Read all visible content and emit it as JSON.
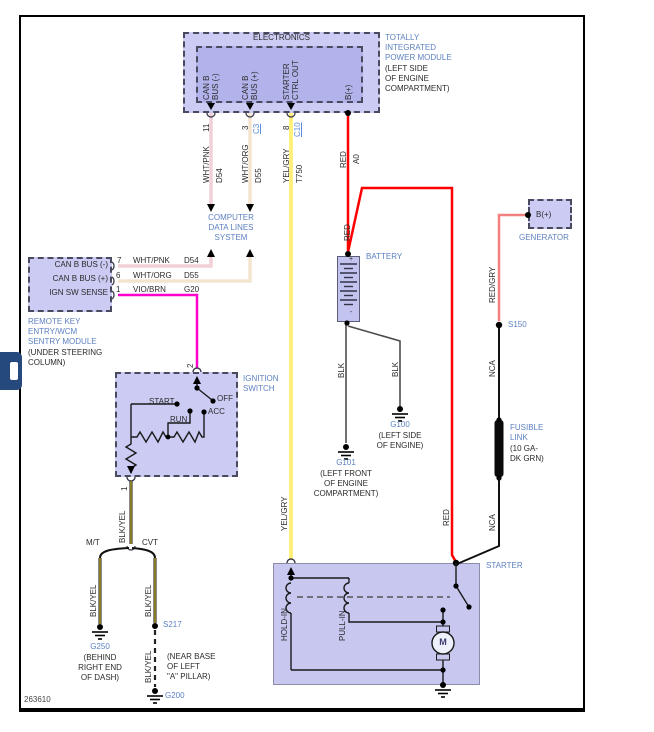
{
  "footer": {
    "diagram_id": "263610"
  },
  "colors": {
    "module_fill": "#cbcbf3",
    "module_inner_fill": "#b3b3ec",
    "label_blue": "#5d81c1",
    "link_blue": "#5b8dd9",
    "wire_red": "#ff0000",
    "wire_red_gry": "#f28080",
    "wire_vio_brn": "#ff00cd",
    "wire_yel_gry": "#ffe200",
    "wire_wht_pnk": "#eab9c2",
    "wire_wht_org": "#ecd7ba",
    "wire_blk": "#4d4d4d",
    "wire_blk_yel_core": "#d7c530",
    "wire_nca": "#111111"
  },
  "tipm": {
    "header": "ELECTRONICS",
    "title": "TOTALLY\nINTEGRATED\nPOWER MODULE",
    "location": "(LEFT SIDE\nOF ENGINE\nCOMPARTMENT)",
    "pins": {
      "p1": {
        "num": "11",
        "signal": "CAN B\nBUS (-)"
      },
      "p2": {
        "num": "3",
        "connector": "C3",
        "signal": "CAN B\nBUS (+)"
      },
      "p3": {
        "num": "8",
        "connector": "C10",
        "signal": "STARTER\nCTRL OUT"
      },
      "p4": {
        "signal": "B(+)"
      }
    },
    "wires": {
      "w1": {
        "color": "WHT/PNK",
        "circuit": "D54"
      },
      "w2": {
        "color": "WHT/ORG",
        "circuit": "D55"
      },
      "w3": {
        "color": "YEL/GRY",
        "circuit": "T750"
      },
      "w4": {
        "color": "RED",
        "circuit": "A0"
      }
    }
  },
  "data_lines": {
    "label": "COMPUTER\nDATA LINES\nSYSTEM"
  },
  "rke": {
    "rows": {
      "r1": {
        "signal": "CAN B BUS (-)",
        "pin": "7",
        "color": "WHT/PNK",
        "circuit": "D54"
      },
      "r2": {
        "signal": "CAN B BUS (+)",
        "pin": "6",
        "color": "WHT/ORG",
        "circuit": "D55"
      },
      "r3": {
        "signal": "IGN SW SENSE",
        "pin": "1",
        "color": "VIO/BRN",
        "circuit": "G20"
      }
    },
    "title": "REMOTE KEY\nENTRY/WCM\nSENTRY MODULE",
    "location": "(UNDER STEERING\nCOLUMN)"
  },
  "ignition": {
    "title": "IGNITION\nSWITCH",
    "pin_top": "2",
    "pin_bottom": "1",
    "positions": {
      "start": "START",
      "run": "RUN",
      "acc": "ACC",
      "off": "OFF"
    },
    "wire_out": "BLK/YEL"
  },
  "battery": {
    "label": "BATTERY",
    "plus": "+",
    "minus": "-",
    "wire_left": "BLK",
    "wire_right": "BLK",
    "g101": {
      "id": "G101",
      "location": "(LEFT FRONT\nOF ENGINE\nCOMPARTMENT)"
    },
    "g100": {
      "id": "G100",
      "location": "(LEFT SIDE\nOF ENGINE)"
    }
  },
  "generator": {
    "pin": "B(+)",
    "label": "GENERATOR",
    "wire": "RED/GRY"
  },
  "splices": {
    "s150": "S150",
    "s217": "S217"
  },
  "fusible": {
    "wire_above": "NCA",
    "label": "FUSIBLE\nLINK",
    "spec": "(10 GA-\nDK GRN)",
    "wire_below": "NCA"
  },
  "red_feed": {
    "label_upper": "RED",
    "label_lower": "RED"
  },
  "starter": {
    "label": "STARTER",
    "wire_in": "YEL/GRY",
    "hold_in": "HOLD-IN",
    "pull_in": "PULL-IN",
    "motor": "M"
  },
  "grounds_left": {
    "wire_top": "BLK/YEL",
    "mt": {
      "label": "M/T",
      "wire": "BLK/YEL",
      "ground": "G250",
      "location": "(BEHIND\nRIGHT END\nOF DASH)"
    },
    "cvt": {
      "label": "CVT",
      "wire": "BLK/YEL",
      "splice_wire": "BLK/YEL",
      "ground": "G200",
      "location": "(NEAR BASE\nOF LEFT\n\"A\" PILLAR)"
    }
  }
}
